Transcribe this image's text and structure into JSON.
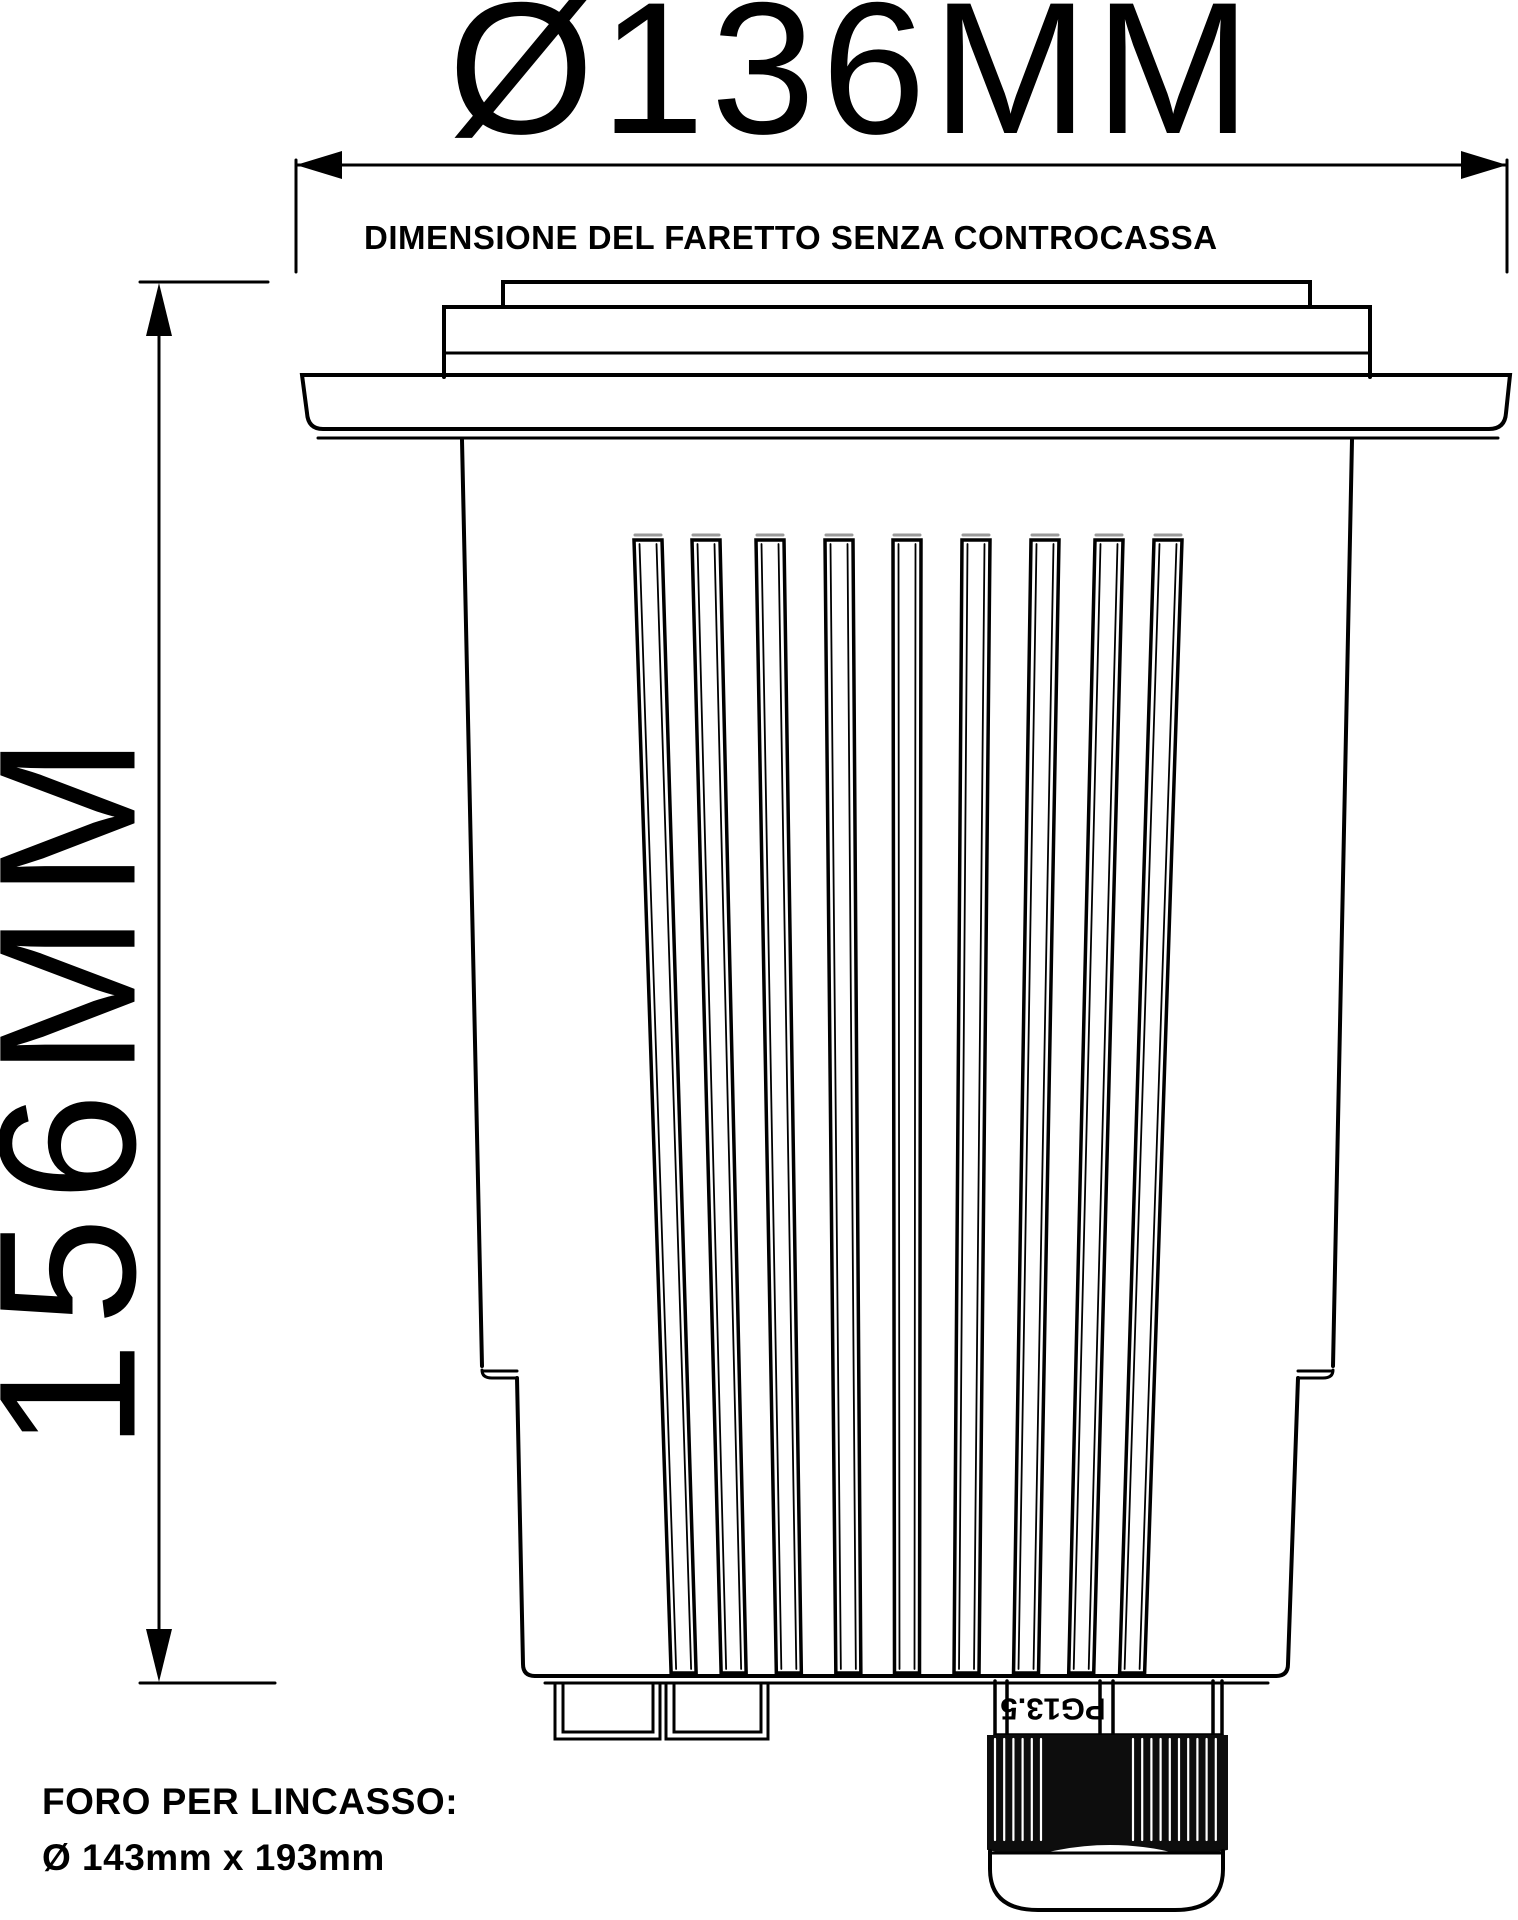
{
  "drawing": {
    "top_dimension": {
      "label": "Ø136MM",
      "caption": "DIMENSIONE DEL FARETTO SENZA CONTROCASSA"
    },
    "side_dimension": {
      "label": "156MM"
    },
    "cable_gland": {
      "label": "PG13.5"
    },
    "recess_note": {
      "line1": "FORO PER LINCASSO:",
      "line2": "Ø 143mm x 193mm"
    },
    "colors": {
      "line": "#000000",
      "text": "#000000",
      "background": "#ffffff",
      "fin_cap": "#9a9a9a",
      "knurl_fill": "#0d0d0d"
    }
  }
}
